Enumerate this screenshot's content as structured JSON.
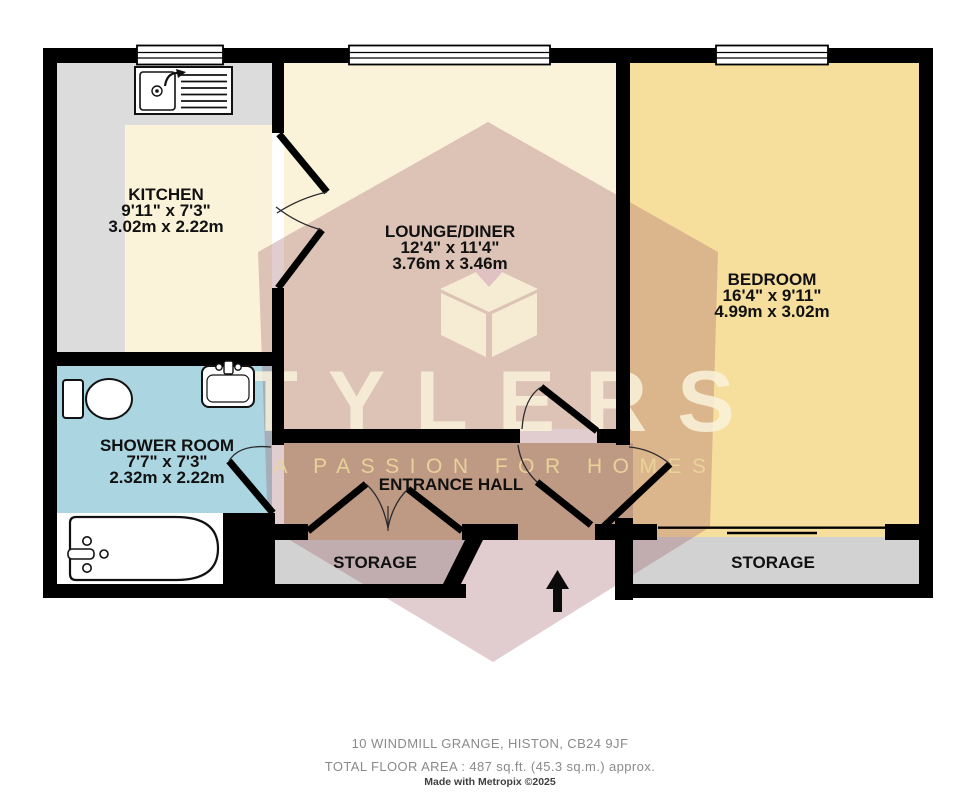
{
  "watermark": {
    "brand": "TYLERS",
    "tagline": "A PASSION FOR HOMES"
  },
  "rooms": {
    "kitchen": {
      "name": "KITCHEN",
      "imperial": "9'11\"  x 7'3\"",
      "metric": "3.02m  x 2.22m"
    },
    "lounge": {
      "name": "LOUNGE/DINER",
      "imperial": "12'4\"  x 11'4\"",
      "metric": "3.76m  x 3.46m"
    },
    "bedroom": {
      "name": "BEDROOM",
      "imperial": "16'4\"  x 9'11\"",
      "metric": "4.99m  x 3.02m"
    },
    "shower": {
      "name": "SHOWER ROOM",
      "imperial": "7'7\"  x 7'3\"",
      "metric": "2.32m  x 2.22m"
    },
    "hall": {
      "name": "ENTRANCE HALL"
    },
    "storage_left": {
      "name": "STORAGE"
    },
    "storage_right": {
      "name": "STORAGE"
    }
  },
  "footer": {
    "address": "10 WINDMILL GRANGE, HISTON, CB24 9JF",
    "area": "TOTAL FLOOR AREA : 487 sq.ft. (45.3 sq.m.) approx.",
    "credit": "Made with Metropix ©2025"
  },
  "colors": {
    "wall": "#000000",
    "kitchen_counter": "#DCDCDC",
    "floor_cream": "#FAF3DA",
    "bedroom_floor": "#F6DE9C",
    "shower_floor": "#ABD5E0",
    "hall_floor": "#CDB693",
    "storage_floor": "#D2D2D2",
    "watermark_maroon": "#9C5662",
    "watermark_cream": "#F7F0D7",
    "label_text": "#111111",
    "footer_text": "#8A8A8A"
  }
}
